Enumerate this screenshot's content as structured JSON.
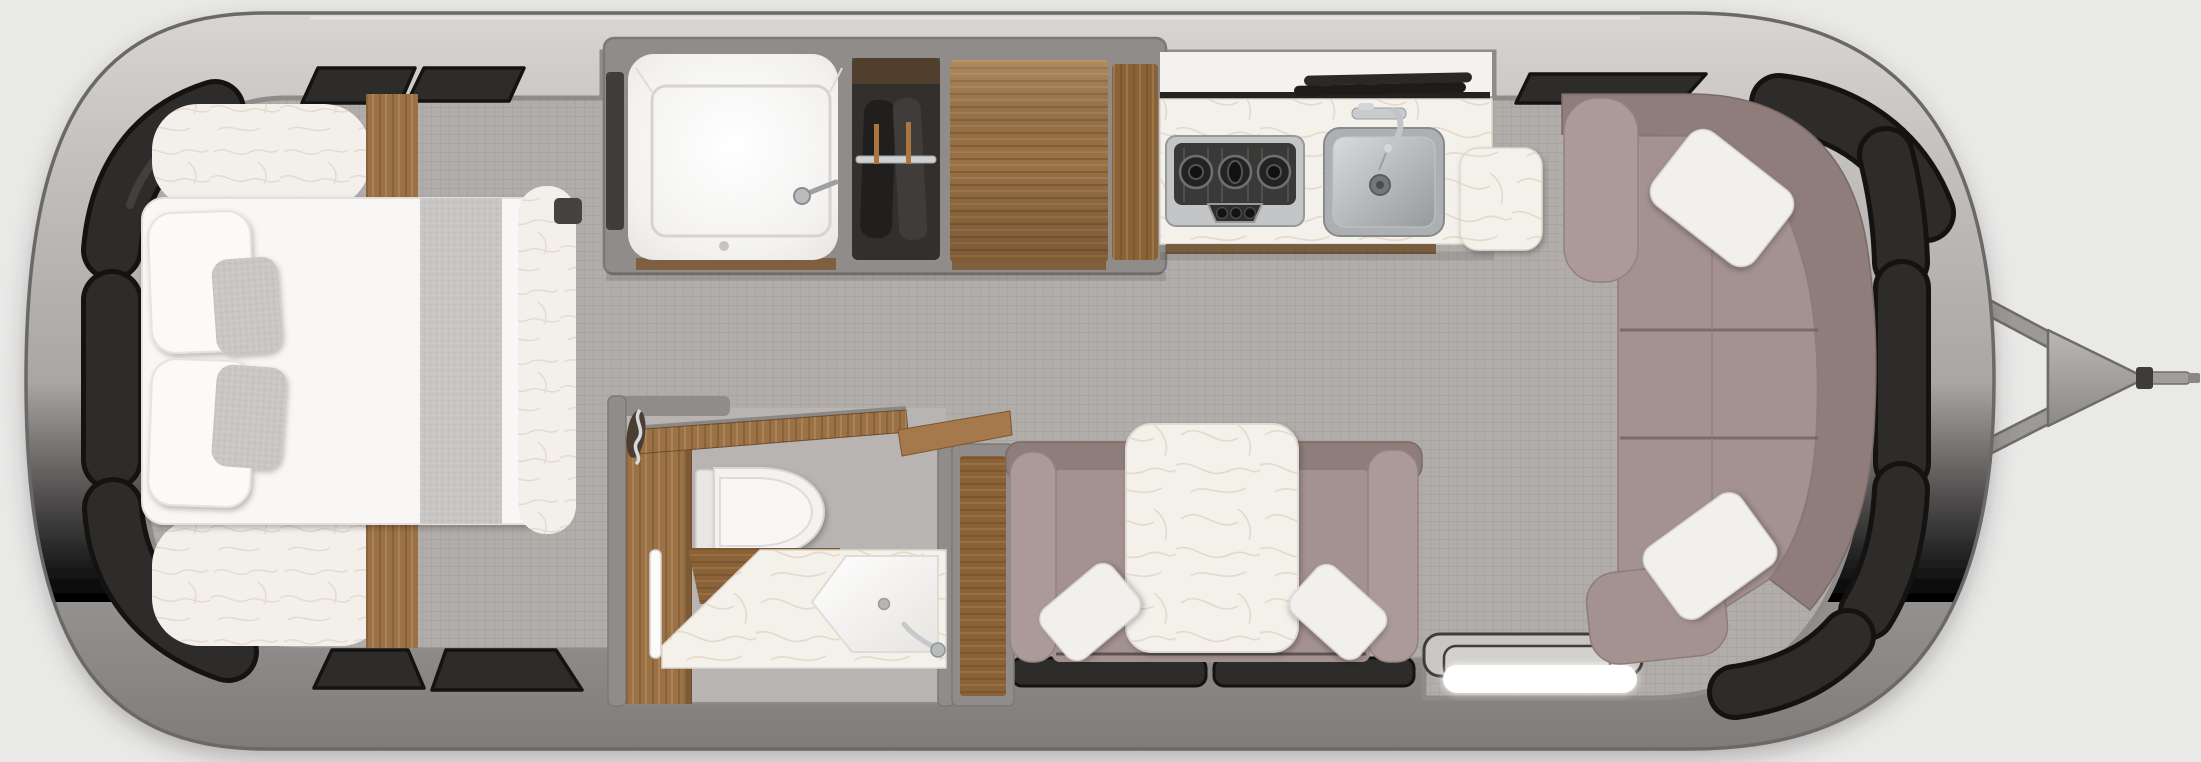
{
  "scene": {
    "type": "floorplan-render",
    "view": "top-down",
    "subject": "travel trailer interior floor plan",
    "hitch_side": "right",
    "text_visible": false
  },
  "colors": {
    "bg": "#e9e9e8",
    "shell_light": "#d8d5d3",
    "shell_mid": "#a9a6a4",
    "shell_dark": "#7f7c7a",
    "shell_outline": "#6b6967",
    "wall": "#8f8c8a",
    "wall_outline": "#7b7977",
    "carpet": "#b1adaa",
    "carpet_line": "#a39d99",
    "bath_floor": "#b7b4b1",
    "window_tint": "#2e2c2a",
    "window_edge": "#141312",
    "mattress": "#f8f7f5",
    "fluff": "#f3efeb",
    "marble": "#f4f1ea",
    "textile_gray": "#c8c6c4",
    "pillow_white": "#f2f0ed",
    "sofa": "#a49290",
    "sofa_back": "#8e7d7a",
    "sofa_arm": "#ab9a97",
    "wood": "#9a7245",
    "wood_dark": "#8a6238",
    "wood_shade": "#7b5833",
    "stainless": "#adb0b2",
    "chrome": "#c9ccce",
    "cooktop_dark": "#393938",
    "black_trim": "#232221",
    "white_cabinet": "#f3f2f0",
    "toilet_white": "#f3f2f0",
    "step_white": "#ffffff",
    "hitch_gray": "#9c9997",
    "wardrobe_dark": "#332f2c"
  },
  "elements": [
    {
      "name": "trailer-shell",
      "kind": "structure"
    },
    {
      "name": "tow-hitch",
      "kind": "structure"
    },
    {
      "name": "perimeter-windows",
      "kind": "window",
      "count": 13
    },
    {
      "name": "bed",
      "kind": "furniture",
      "details": [
        "2 white pillows",
        "2 gray accent pillows",
        "gray throw",
        "fluffy comforter"
      ]
    },
    {
      "name": "bedside-wood-cabinets",
      "kind": "furniture",
      "count": 2
    },
    {
      "name": "shower",
      "kind": "fixture",
      "details": [
        "shower pan",
        "showerhead",
        "drain"
      ]
    },
    {
      "name": "wardrobe",
      "kind": "storage",
      "details": [
        "hanging rail",
        "garments"
      ]
    },
    {
      "name": "pantry-cabinet",
      "kind": "storage"
    },
    {
      "name": "kitchen-counter",
      "kind": "counter",
      "details": [
        "marble top",
        "3-burner cooktop",
        "stainless sink",
        "faucet",
        "black trim",
        "flip trays"
      ]
    },
    {
      "name": "side-table",
      "kind": "counter"
    },
    {
      "name": "bathroom",
      "kind": "room",
      "details": [
        "toilet",
        "wood vanity",
        "towel bar",
        "marble vanity with corner sink",
        "faucet",
        "open wood door",
        "wood shelf",
        "towel ring"
      ]
    },
    {
      "name": "linen-cabinet",
      "kind": "storage"
    },
    {
      "name": "dinette",
      "kind": "furniture",
      "details": [
        "face-to-face benches",
        "marble table",
        "2 white pillows"
      ]
    },
    {
      "name": "entry-step",
      "kind": "structure",
      "details": [
        "2 treads",
        "illuminated white step"
      ]
    },
    {
      "name": "sofa",
      "kind": "furniture",
      "details": [
        "curved back",
        "3 seat cushions",
        "arm cushion",
        "chaise end",
        "2 white pillows"
      ]
    }
  ]
}
